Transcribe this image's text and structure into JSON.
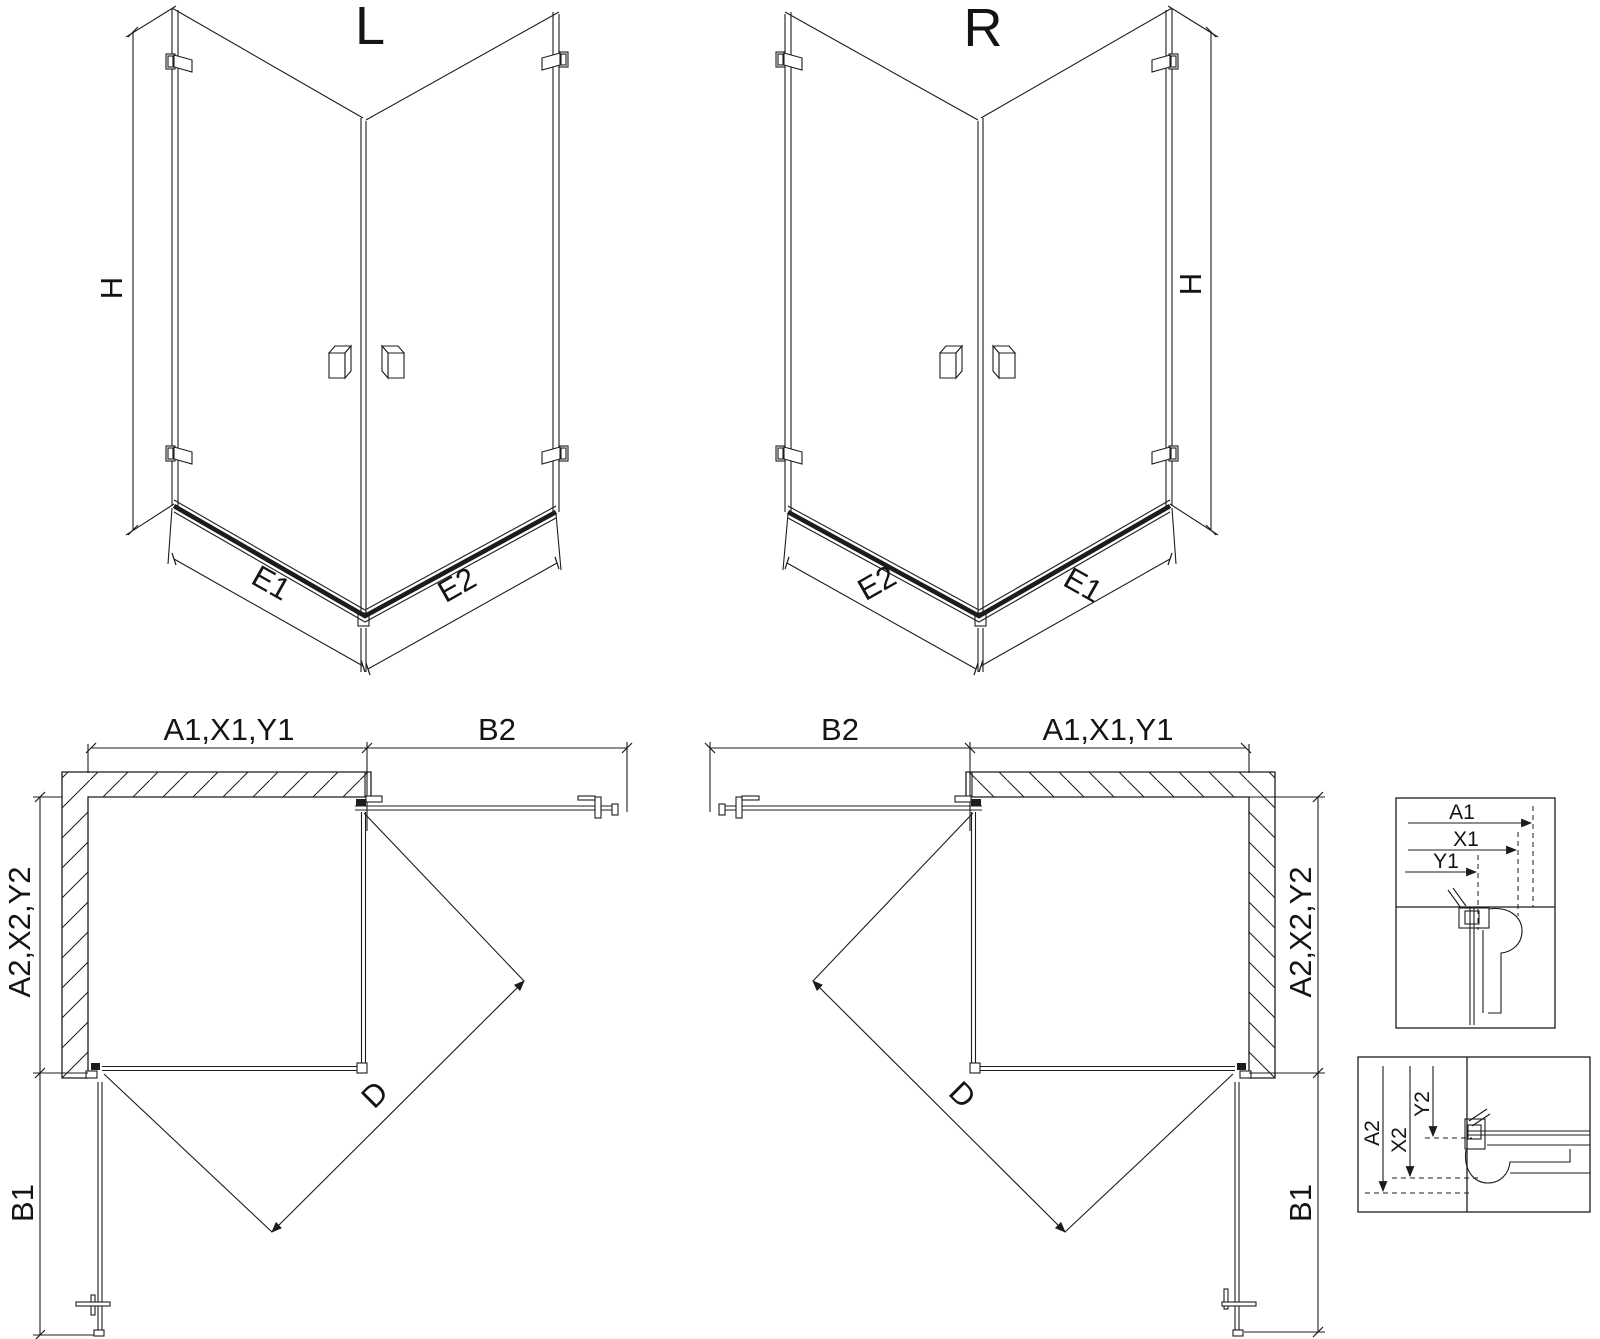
{
  "page": {
    "background": "#ffffff",
    "line_color": "#1c1c1c"
  },
  "iso_left": {
    "label": "L",
    "height_dim": "H",
    "left_bottom_dim": "E1",
    "right_bottom_dim": "E2"
  },
  "iso_right": {
    "label": "R",
    "height_dim": "H",
    "left_bottom_dim": "E2",
    "right_bottom_dim": "E1"
  },
  "plan_left": {
    "top_wall_dim": "A1,X1,Y1",
    "top_entry_dim": "B2",
    "side_wall_dim": "A2,X2,Y2",
    "side_entry_dim": "B1",
    "diagonal_dim": "D"
  },
  "plan_right": {
    "top_wall_dim": "A1,X1,Y1",
    "top_entry_dim": "B2",
    "side_wall_dim": "A2,X2,Y2",
    "side_entry_dim": "B1",
    "diagonal_dim": "D"
  },
  "detail_top": {
    "dim_a": "A1",
    "dim_x": "X1",
    "dim_y": "Y1"
  },
  "detail_bottom": {
    "dim_a": "A2",
    "dim_x": "X2",
    "dim_y": "Y2"
  }
}
